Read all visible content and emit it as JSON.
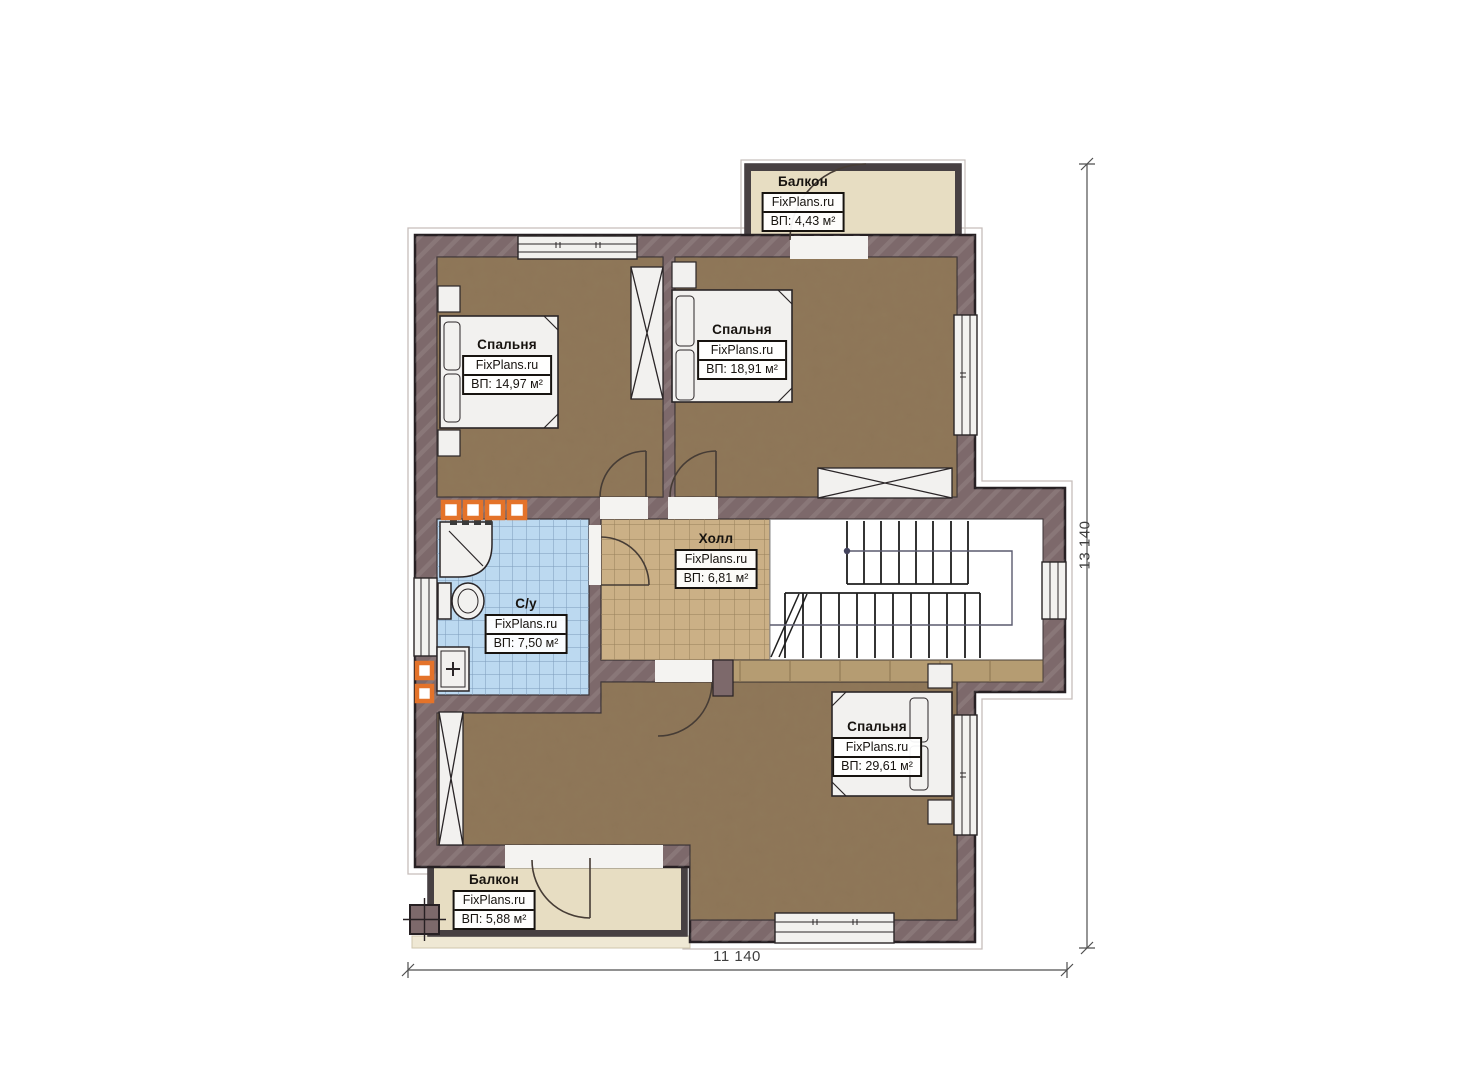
{
  "plan": {
    "rooms": [
      {
        "id": "bedroom-top-left",
        "name": "Спальня",
        "brand": "FixPlans.ru",
        "area": "ВП: 14,97 м²"
      },
      {
        "id": "bedroom-top-right",
        "name": "Спальня",
        "brand": "FixPlans.ru",
        "area": "ВП: 18,91 м²"
      },
      {
        "id": "hall",
        "name": "Холл",
        "brand": "FixPlans.ru",
        "area": "ВП: 6,81 м²"
      },
      {
        "id": "bathroom",
        "name": "С/у",
        "brand": "FixPlans.ru",
        "area": "ВП: 7,50 м²"
      },
      {
        "id": "bedroom-bottom",
        "name": "Спальня",
        "brand": "FixPlans.ru",
        "area": "ВП: 29,61 м²"
      },
      {
        "id": "balcony-top",
        "name": "Балкон",
        "brand": "FixPlans.ru",
        "area": "ВП: 4,43 м²"
      },
      {
        "id": "balcony-bottom",
        "name": "Балкон",
        "brand": "FixPlans.ru",
        "area": "ВП: 5,88 м²"
      }
    ],
    "dimensions": {
      "width_label": "11 140",
      "height_label": "13 140"
    },
    "colors": {
      "wall": "#7d696b",
      "bedroom_floor": "#8d7557",
      "hall_floor": "#cbb086",
      "bathroom_floor": "#bcd9f0",
      "balcony_floor": "#e7ddc2",
      "accent_orange": "#e4732a"
    }
  }
}
